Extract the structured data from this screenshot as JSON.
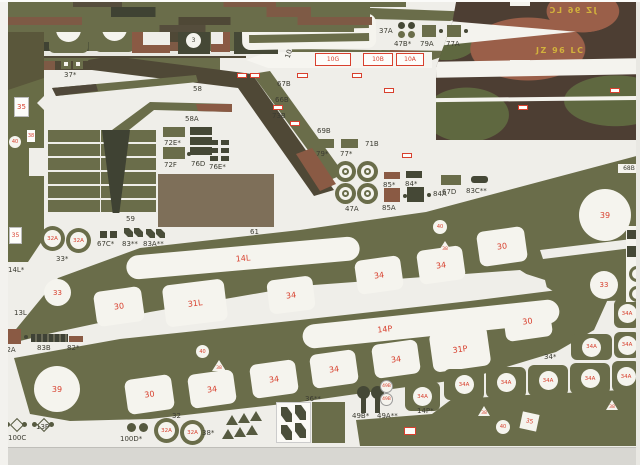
{
  "page": {
    "marking": "JZ 96 LC"
  },
  "top_left": {
    "p31L": "31L*",
    "p31P": "31P*",
    "n32": "32",
    "p37": "37*",
    "p6": "6**",
    "n3": "3",
    "p10P": "10P",
    "p10L": "10L",
    "t35": "35",
    "t38": "38",
    "t40": "40",
    "t35b": "35"
  },
  "top_mid": {
    "p37A": "37A",
    "p47B": "47B*",
    "p79A": "79A",
    "p77A": "77A",
    "g10G": "10G",
    "g10B": "10B",
    "g10A": "10A"
  },
  "strips": {
    "p67B": "67B",
    "p66B": "66B",
    "p73B": "73B",
    "p69B": "69B",
    "p71B": "71B",
    "p68B": "68B",
    "p79": "79*",
    "p77": "77*"
  },
  "left": {
    "p58": "58",
    "p58A": "58A",
    "p72E": "72E*",
    "p72F": "72F",
    "p76D": "76D",
    "p76E": "76E*",
    "p59": "59",
    "p61": "61"
  },
  "mid": {
    "p47A": "47A",
    "p85s": "85*",
    "p84s": "84*",
    "p85A": "85A",
    "p84A": "84A",
    "p67D": "67D",
    "p83C": "83C**",
    "p33s": "33*",
    "p67C": "67C*",
    "p83": "83**",
    "p83A": "83A**",
    "rings": [
      "32A",
      "32A"
    ]
  },
  "band1": {
    "pre": "14L*",
    "side": "13L",
    "label": "14L",
    "squares": [
      "33",
      "30",
      "31L",
      "34",
      "34",
      "34",
      "30",
      "33"
    ],
    "n39": "39",
    "t40": "40",
    "t38": "38"
  },
  "below1": {
    "p82A": "82A",
    "p83B": "83B",
    "p82": "82*"
  },
  "band2": {
    "side": "13P",
    "label": "14P",
    "squares": [
      "39",
      "30",
      "34",
      "34",
      "34",
      "34",
      "31P",
      "30"
    ],
    "t40": "40",
    "t38": "38"
  },
  "tiles": {
    "n34A": "34A",
    "p34s": "34*",
    "p14Ps": "14P*"
  },
  "bottom": {
    "p100C": "100C",
    "p100D": "100D*",
    "p32": "32",
    "rings": [
      "32A",
      "32A"
    ],
    "p38s": "38*",
    "p36": "36**",
    "p49Bs": "49B*",
    "p49As": "49A**",
    "c49": [
      "49B",
      "49B"
    ],
    "t40": "40",
    "t35": "35"
  }
}
